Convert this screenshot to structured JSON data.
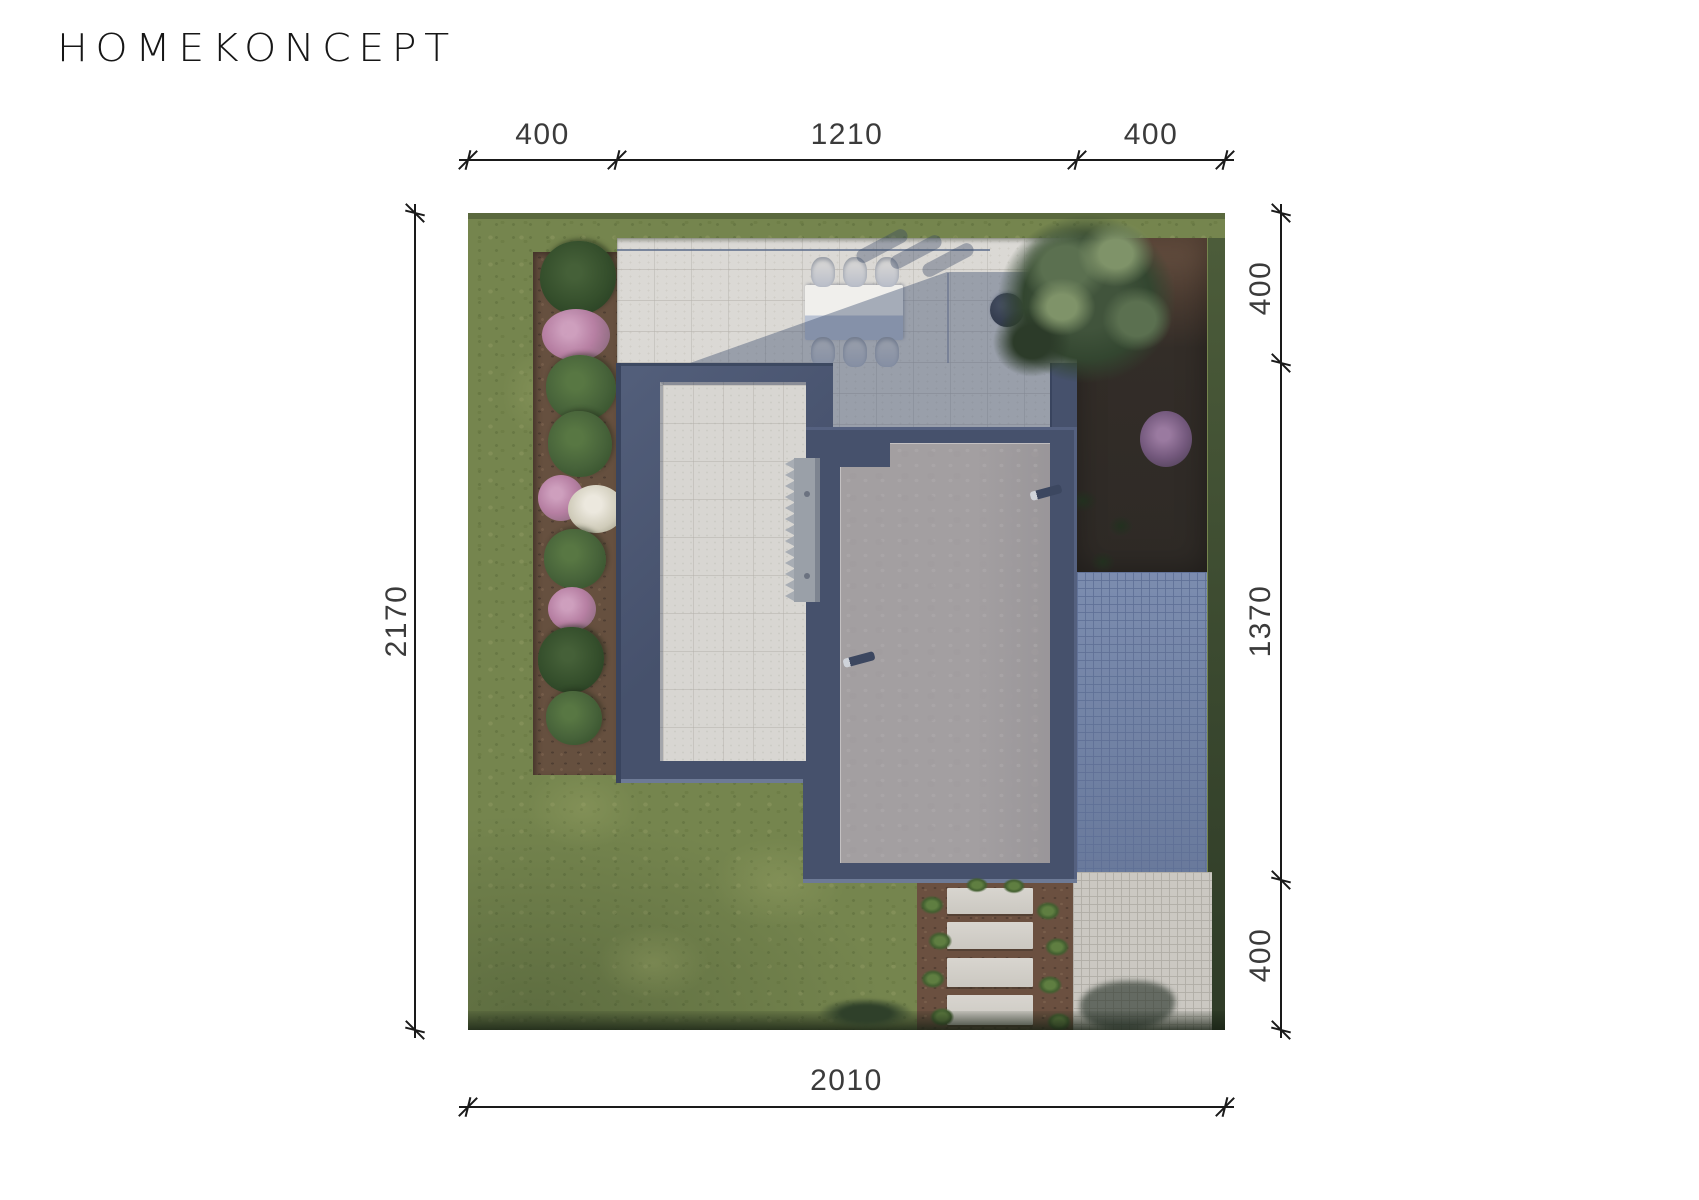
{
  "brand": {
    "logo_text": "HOMEKONCEPT"
  },
  "dimensions": {
    "top": {
      "segments": [
        "400",
        "1210",
        "400"
      ]
    },
    "right": {
      "segments": [
        "400",
        "1370",
        "400"
      ]
    },
    "left": {
      "total": "2170"
    },
    "bottom": {
      "total": "2010"
    }
  },
  "scene": {
    "description": "aerial-site-plan-render",
    "colors": {
      "roof_navy": "#46516c",
      "roof_gray": "#a39fa1",
      "terrace_concrete": "#dbd9d5",
      "courtyard_pavers": "#d8d6d2",
      "grass": "#75854e",
      "mulch": "#66503f",
      "blue_pavers": "#7284a9",
      "light_pavers": "#cbc8c2",
      "shadow_tint": "rgba(62,78,112,0.42)",
      "dimension_ink": "#1a1a1a"
    },
    "sprites": [
      {
        "k": "grass-patch",
        "x": 40,
        "y": 540,
        "w": 150,
        "h": 110
      },
      {
        "k": "grass-patch",
        "x": 220,
        "y": 610,
        "w": 180,
        "h": 120
      },
      {
        "k": "grass-patch",
        "x": 110,
        "y": 700,
        "w": 150,
        "h": 100
      },
      {
        "k": "grass-patch",
        "x": 20,
        "y": 120,
        "w": 110,
        "h": 120
      },
      {
        "k": "bush-dark",
        "x": 72,
        "y": 28,
        "w": 76,
        "h": 74
      },
      {
        "k": "flower-pink",
        "x": 74,
        "y": 96,
        "w": 68,
        "h": 52
      },
      {
        "k": "bush",
        "x": 78,
        "y": 142,
        "w": 70,
        "h": 66
      },
      {
        "k": "bush",
        "x": 80,
        "y": 198,
        "w": 64,
        "h": 66
      },
      {
        "k": "flower-pink",
        "x": 70,
        "y": 262,
        "w": 46,
        "h": 46
      },
      {
        "k": "flower-white",
        "x": 100,
        "y": 272,
        "w": 56,
        "h": 48
      },
      {
        "k": "bush",
        "x": 76,
        "y": 316,
        "w": 62,
        "h": 60
      },
      {
        "k": "flower-pink",
        "x": 80,
        "y": 374,
        "w": 48,
        "h": 44
      },
      {
        "k": "bush-dark",
        "x": 70,
        "y": 414,
        "w": 66,
        "h": 66
      },
      {
        "k": "bush",
        "x": 78,
        "y": 478,
        "w": 56,
        "h": 54
      },
      {
        "k": "chair",
        "x": 343,
        "y": 44,
        "w": 24,
        "h": 30
      },
      {
        "k": "chair",
        "x": 375,
        "y": 44,
        "w": 24,
        "h": 30
      },
      {
        "k": "chair",
        "x": 407,
        "y": 44,
        "w": 24,
        "h": 30
      },
      {
        "k": "chair",
        "x": 343,
        "y": 124,
        "w": 24,
        "h": 30
      },
      {
        "k": "chair",
        "x": 375,
        "y": 124,
        "w": 24,
        "h": 30
      },
      {
        "k": "chair",
        "x": 407,
        "y": 124,
        "w": 24,
        "h": 30
      },
      {
        "k": "chair-shadow",
        "x": 386,
        "y": 26,
        "w": 56,
        "h": 14,
        "r": -28
      },
      {
        "k": "chair-shadow",
        "x": 420,
        "y": 32,
        "w": 56,
        "h": 14,
        "r": -28
      },
      {
        "k": "chair-shadow",
        "x": 452,
        "y": 40,
        "w": 56,
        "h": 14,
        "r": -28
      },
      {
        "k": "fire-bowl",
        "x": 522,
        "y": 80,
        "w": 34,
        "h": 34
      },
      {
        "k": "lounger",
        "x": 560,
        "y": 100,
        "w": 34,
        "h": 38,
        "r": 34
      },
      {
        "k": "roof-drain",
        "x": 562,
        "y": 275,
        "w": 32,
        "h": 9,
        "r": -15
      },
      {
        "k": "roof-drain",
        "x": 375,
        "y": 442,
        "w": 32,
        "h": 9,
        "r": -15
      },
      {
        "k": "tree-base",
        "x": 528,
        "y": 0,
        "w": 182,
        "h": 172
      },
      {
        "k": "tree-mid",
        "x": 545,
        "y": 8,
        "w": 104,
        "h": 92
      },
      {
        "k": "tree-light",
        "x": 600,
        "y": 0,
        "w": 96,
        "h": 82
      },
      {
        "k": "tree-light",
        "x": 552,
        "y": 58,
        "w": 84,
        "h": 72
      },
      {
        "k": "tree-mid",
        "x": 628,
        "y": 68,
        "w": 82,
        "h": 76
      },
      {
        "k": "tree-dark",
        "x": 518,
        "y": 88,
        "w": 92,
        "h": 82
      },
      {
        "k": "bush-dark",
        "x": 528,
        "y": 180,
        "w": 60,
        "h": 56
      },
      {
        "k": "flower-purple",
        "x": 672,
        "y": 198,
        "w": 52,
        "h": 56
      },
      {
        "k": "shrub-dot",
        "x": 560,
        "y": 250,
        "w": 26,
        "h": 22
      },
      {
        "k": "shrub-dot",
        "x": 600,
        "y": 276,
        "w": 30,
        "h": 24
      },
      {
        "k": "shrub-dot",
        "x": 640,
        "y": 302,
        "w": 26,
        "h": 22
      },
      {
        "k": "shrub-dot",
        "x": 580,
        "y": 312,
        "w": 22,
        "h": 20
      },
      {
        "k": "shrub-dot",
        "x": 622,
        "y": 338,
        "w": 26,
        "h": 22
      },
      {
        "k": "slab",
        "x": 479,
        "y": 675,
        "w": 86,
        "h": 26
      },
      {
        "k": "slab",
        "x": 479,
        "y": 709,
        "w": 86,
        "h": 27
      },
      {
        "k": "slab",
        "x": 479,
        "y": 745,
        "w": 86,
        "h": 29
      },
      {
        "k": "slab",
        "x": 479,
        "y": 782,
        "w": 86,
        "h": 30
      },
      {
        "k": "tuft",
        "x": 451,
        "y": 682,
        "w": 26,
        "h": 20
      },
      {
        "k": "tuft",
        "x": 459,
        "y": 718,
        "w": 26,
        "h": 20
      },
      {
        "k": "tuft",
        "x": 452,
        "y": 756,
        "w": 26,
        "h": 20
      },
      {
        "k": "tuft",
        "x": 461,
        "y": 794,
        "w": 26,
        "h": 20
      },
      {
        "k": "tuft",
        "x": 567,
        "y": 688,
        "w": 26,
        "h": 20
      },
      {
        "k": "tuft",
        "x": 576,
        "y": 724,
        "w": 26,
        "h": 20
      },
      {
        "k": "tuft",
        "x": 569,
        "y": 762,
        "w": 26,
        "h": 20
      },
      {
        "k": "tuft",
        "x": 578,
        "y": 799,
        "w": 26,
        "h": 20
      },
      {
        "k": "tuft",
        "x": 497,
        "y": 664,
        "w": 24,
        "h": 16
      },
      {
        "k": "tuft",
        "x": 534,
        "y": 665,
        "w": 24,
        "h": 16
      },
      {
        "k": "shade-blob",
        "x": 612,
        "y": 768,
        "w": 95,
        "h": 49
      },
      {
        "k": "hedge",
        "x": 348,
        "y": 784,
        "w": 100,
        "h": 33
      }
    ]
  }
}
